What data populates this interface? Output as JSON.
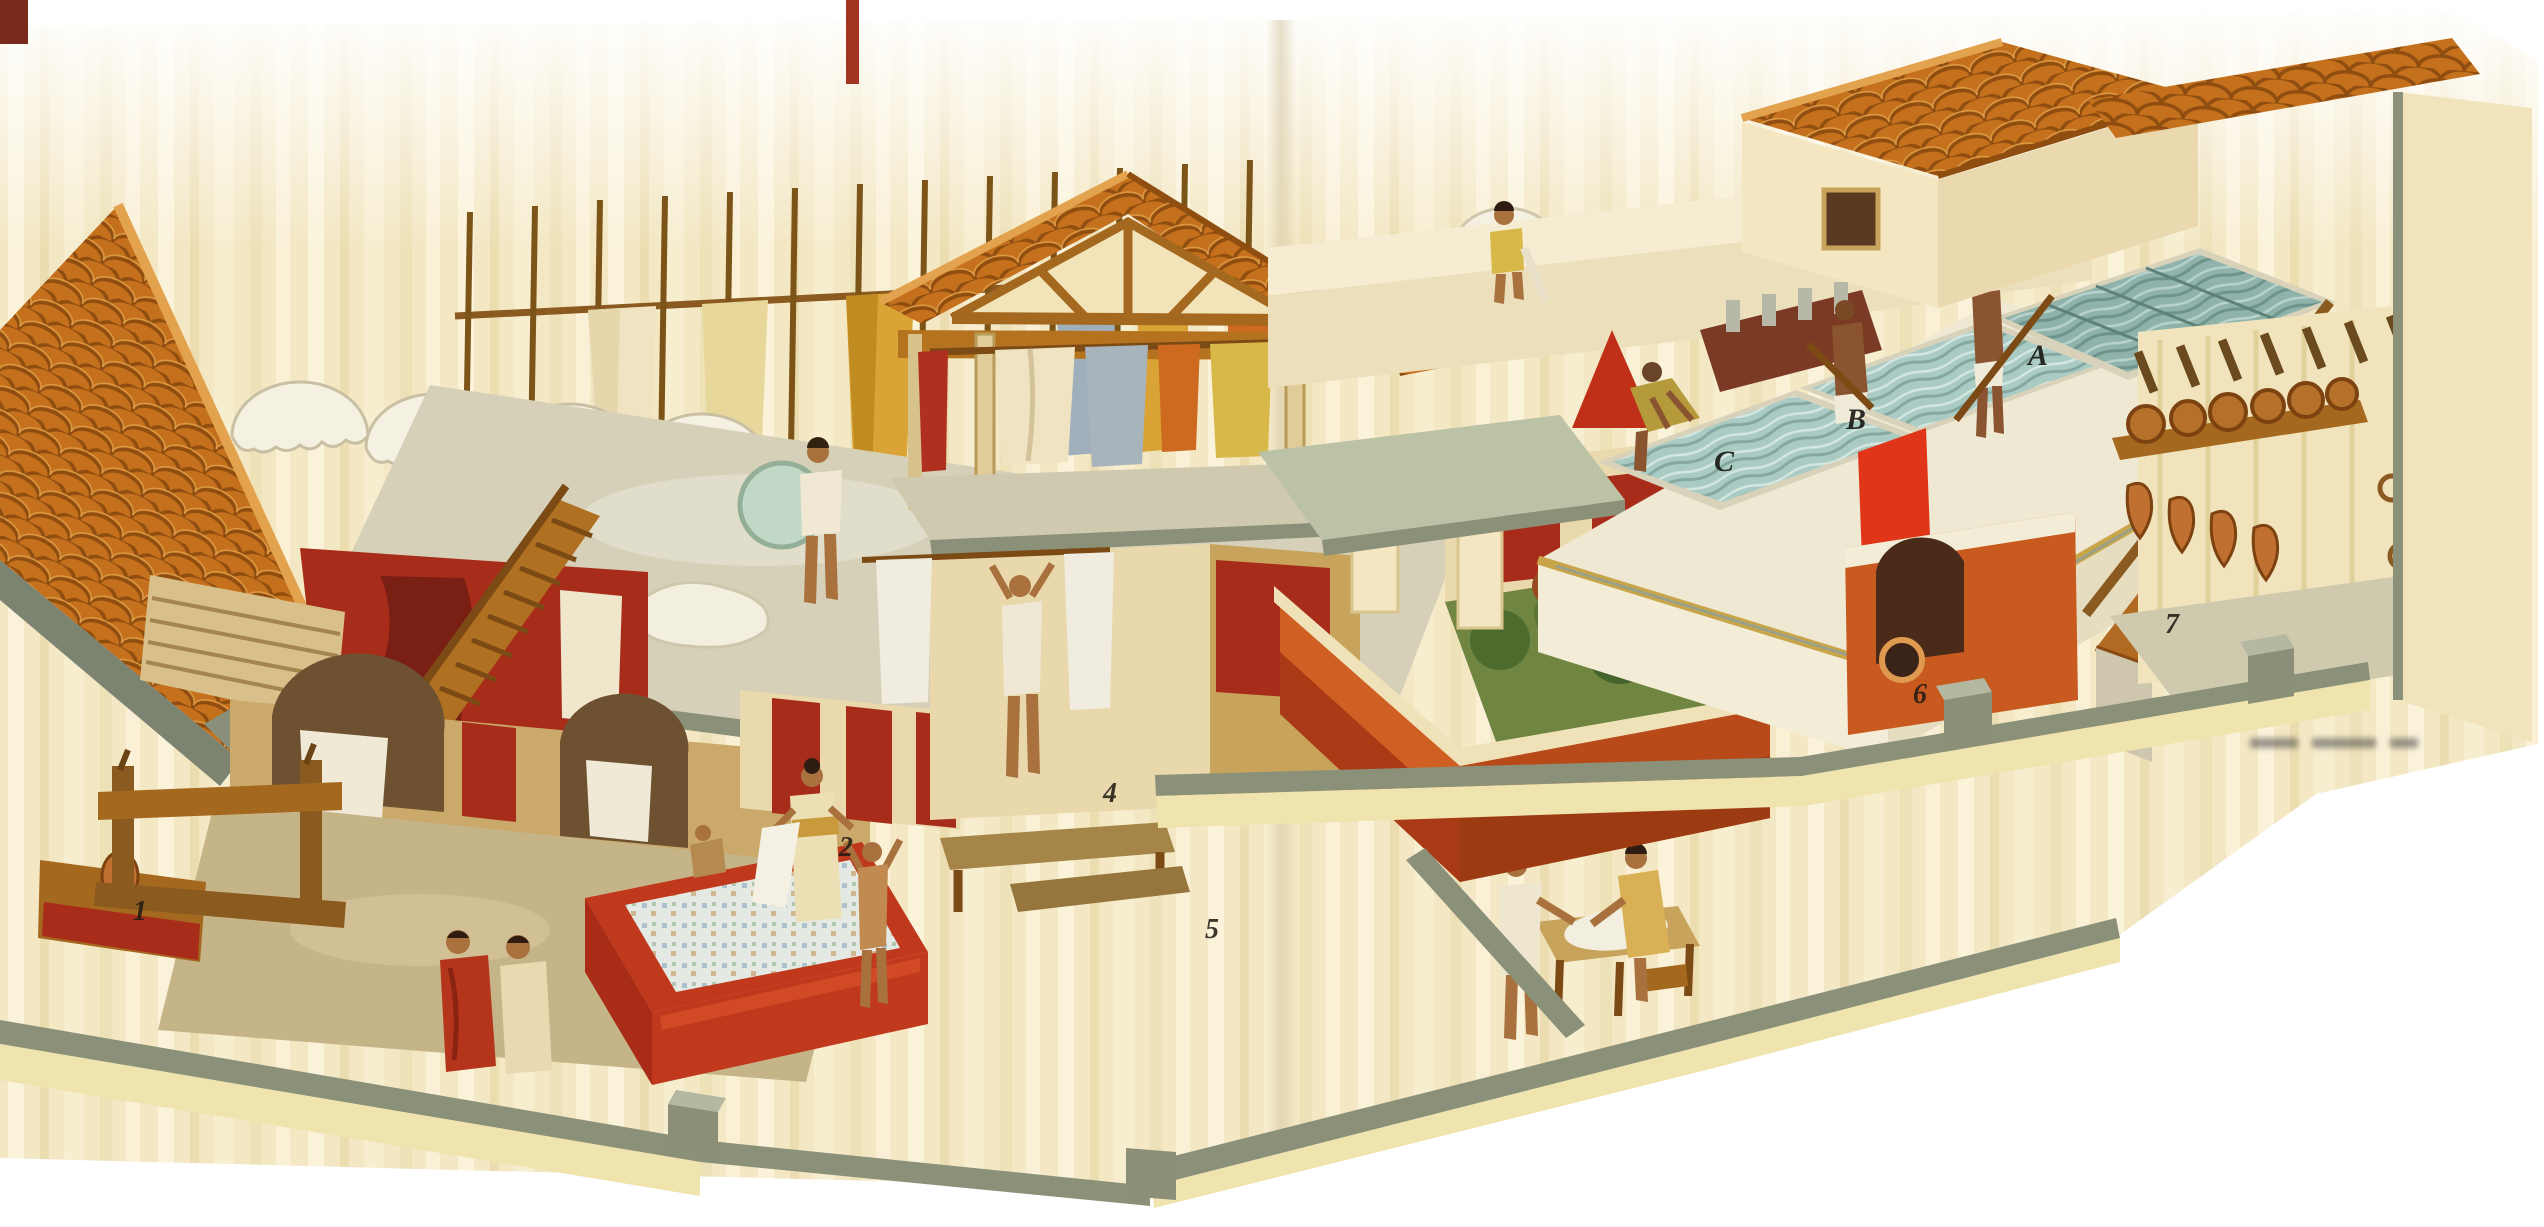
{
  "callouts": {
    "n1": "1",
    "n2": "2",
    "n4": "4",
    "n5": "5",
    "n6": "6",
    "n7": "7",
    "A": "A",
    "B": "B",
    "C": "C"
  },
  "palette": {
    "page_white": "#ffffff",
    "parchment": "#f3e7c4",
    "roof_tile": "#c4701c",
    "roof_tile_shadow": "#8f4d10",
    "wall_cream": "#f3e6c0",
    "wall_deep_cream": "#e9d9ad",
    "red_wall": "#a82c1a",
    "bright_red": "#d43a1c",
    "orange_wall": "#c85a20",
    "wall_cap_gray": "#8b9179",
    "terrace_gray": "#d6d0b8",
    "floor_tan": "#c6b489",
    "water_turquoise": "#a9cbc3",
    "wood": "#a5681f",
    "grass_green": "#64803a",
    "cloth_white": "#f2eee0",
    "cloth_gold": "#d9a435",
    "cloth_blue": "#9fb0bc",
    "skin_tone": "#a9713d"
  }
}
